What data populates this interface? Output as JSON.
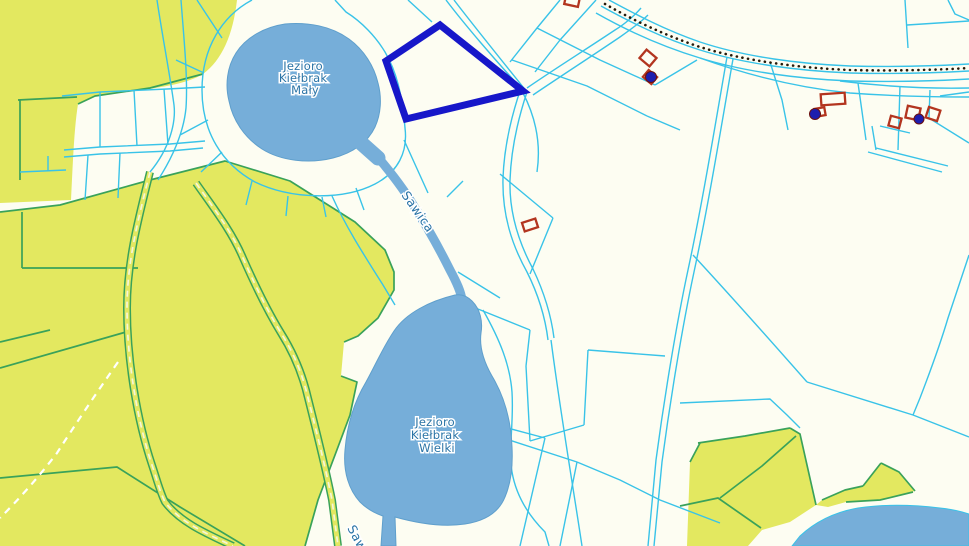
{
  "map": {
    "type": "cadastral-parcel-map",
    "labels": {
      "lake_small": {
        "lines": [
          "Jezioro",
          "Kiełbrak",
          "Mały"
        ]
      },
      "lake_big": {
        "lines": [
          "Jezioro",
          "Kiełbrak",
          "Wielki"
        ]
      },
      "river": "Sawica",
      "river_bottom": "Sawica"
    },
    "colors": {
      "background": "#fdfdf2",
      "forest": "#e3e860",
      "water": "#76aed9",
      "water_edge": "#5f9fcc",
      "parcel_line": "#39c3e8",
      "forest_line": "#3aa25a",
      "road_center_dash": "#f5f5d8",
      "trail_dash": "#ffffff",
      "selected_parcel_outline": "#1717c9",
      "building_outline": "#b3351f",
      "address_point": "#1e1eae",
      "boundary_dots": "#241a0a",
      "label_text": "#2b74a6"
    }
  }
}
